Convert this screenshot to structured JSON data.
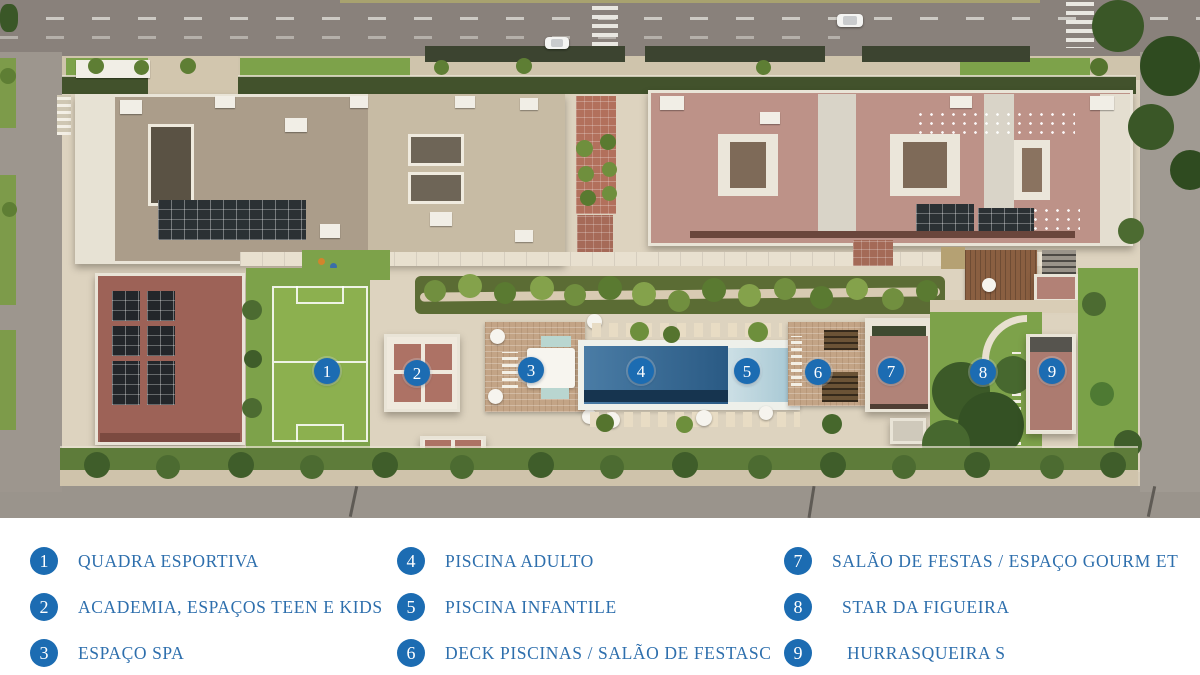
{
  "map": {
    "markers": [
      {
        "num": "1"
      },
      {
        "num": "2"
      },
      {
        "num": "3"
      },
      {
        "num": "4"
      },
      {
        "num": "5"
      },
      {
        "num": "6"
      },
      {
        "num": "7"
      },
      {
        "num": "8"
      },
      {
        "num": "9"
      }
    ]
  },
  "legend": {
    "items": [
      {
        "num": "1",
        "label": "QUADRA ESPORTIVA"
      },
      {
        "num": "2",
        "label": "ACADEMIA, ESPAÇOS TEEN E KIDS"
      },
      {
        "num": "3",
        "label": "ESPAÇO SPA"
      },
      {
        "num": "4",
        "label": "PISCINA ADULTO"
      },
      {
        "num": "5",
        "label": "PISCINA INFANTILE"
      },
      {
        "num": "6",
        "label": "DECK PISCINAS / SALÃO DE FESTASC"
      },
      {
        "num": "7",
        "label": "SALÃO DE FESTAS / ESPAÇO GOURM ET"
      },
      {
        "num": "8",
        "label": "STAR DA FIGUEIRA"
      },
      {
        "num": "9",
        "label": "HURRASQUEIRA S"
      }
    ]
  },
  "colors": {
    "marker_blue": "#1c6cb2",
    "legend_text_blue": "#2e6fad",
    "pool_blue": "#2a5a84",
    "kids_pool_blue": "#a7c8d4",
    "roof_terracotta": "#bd9288",
    "roof_concrete": "#ab9d8a",
    "lawn_green": "#7da24a"
  }
}
